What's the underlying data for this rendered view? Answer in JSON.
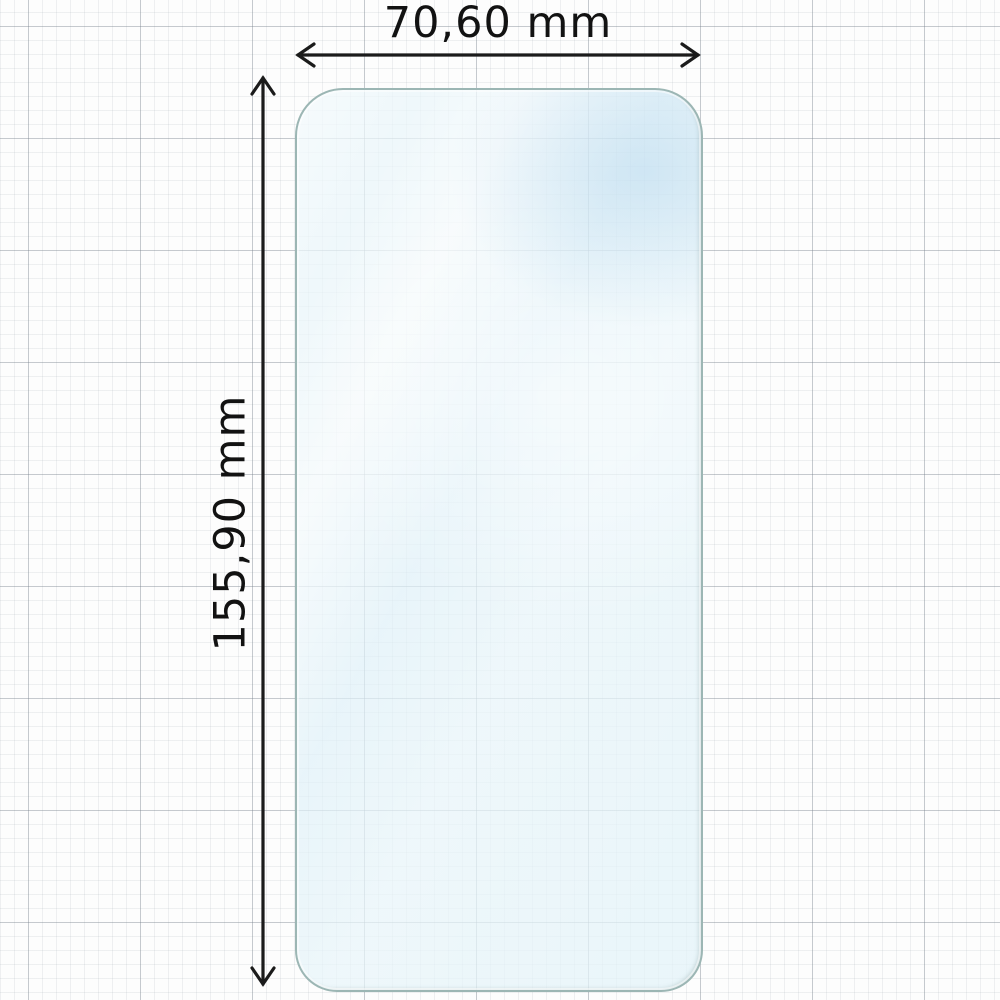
{
  "diagram": {
    "subject": "phone-screen-protector",
    "dimensions": {
      "width": {
        "label": "70,60 mm",
        "value_mm": 70.6,
        "unit": "mm"
      },
      "height": {
        "label": "155,90 mm",
        "value_mm": 155.9,
        "unit": "mm"
      }
    },
    "icons": {
      "width_arrow": "double-headed-horizontal-arrow",
      "height_arrow": "double-headed-vertical-arrow"
    },
    "colors": {
      "page_background": "#fdfdfd",
      "grid_major": "#d4d8db",
      "grid_minor": "#ededef",
      "dimension_line": "#1b1b1b",
      "label_text": "#121212",
      "protector_edge": "#9cb6b4",
      "protector_tint": "#e3f1f8"
    }
  }
}
